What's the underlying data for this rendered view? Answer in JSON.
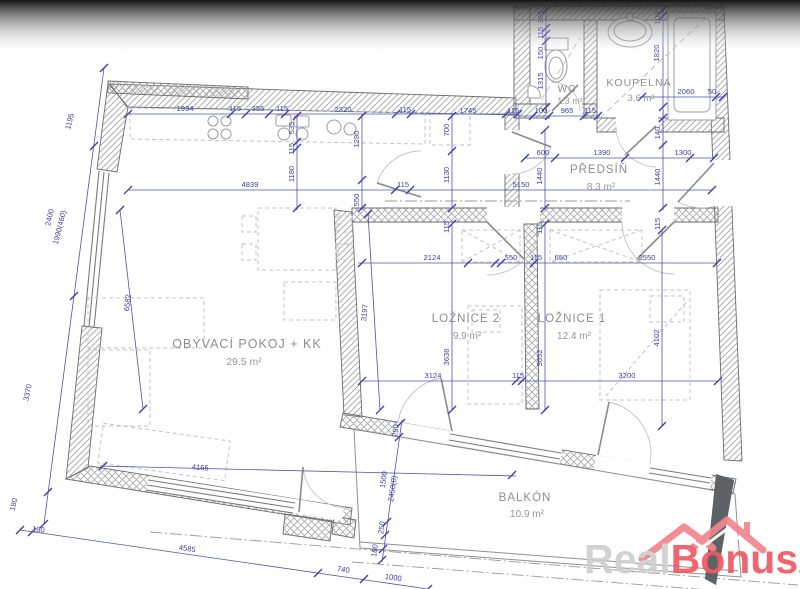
{
  "rooms": [
    {
      "name": "OBÝVACÍ POKOJ + KK",
      "area": "29.5 m²"
    },
    {
      "name": "LOŽNICE 2",
      "area": "9.9 m²"
    },
    {
      "name": "LOŽNICE 1",
      "area": "12.4 m²"
    },
    {
      "name": "PŘEDSÍŇ",
      "area": "8.3 m²"
    },
    {
      "name": "WC",
      "area": "1.3 m²"
    },
    {
      "name": "KOUPELNA",
      "area": "3.6 m²"
    },
    {
      "name": "BALKÓN",
      "area": "10.9 m²"
    }
  ],
  "dimensions": {
    "top_chain": [
      "1934",
      "115",
      "355",
      "115",
      "2320",
      "115",
      "1745",
      "115"
    ],
    "wc_bottom_chain": [
      "100",
      "965",
      "115"
    ],
    "wc_left_chain": [
      "365",
      "115",
      "150",
      "1315"
    ],
    "koupelna_dims": [
      "100",
      "1820",
      "2060",
      "50"
    ],
    "mid_chain": [
      "4839",
      "115",
      "5150"
    ],
    "kitchen_col": [
      "535",
      "115",
      "1180"
    ],
    "mid_verticals": [
      "1280",
      "550",
      "700",
      "1130"
    ],
    "predsin_chain": [
      "600",
      "1390",
      "1300"
    ],
    "predsin_verticals": [
      "1440",
      "140",
      "1440"
    ],
    "wall_thickness": [
      "115",
      "115",
      "115"
    ],
    "bedroom_top_chain": [
      "2124",
      "550",
      "115",
      "650",
      "2550"
    ],
    "bedroom_verticals": [
      "3197",
      "3636",
      "3652",
      "4102"
    ],
    "bedroom_bottom_chain": [
      "3124",
      "115",
      "3200"
    ],
    "living_diag": [
      "6582"
    ],
    "left_outer_chain": [
      "1195",
      "2400",
      "1990(460)",
      "3370",
      "180"
    ],
    "bottom_outer_chain": [
      "180",
      "4585",
      "740",
      "1000"
    ],
    "living_bottom": [
      "4165"
    ],
    "balcony_chain": [
      "250",
      "1500",
      "2450(0)",
      "250",
      "180"
    ]
  },
  "watermark": {
    "real": "Real",
    "bonus": "Bonus",
    "tld": ".cz"
  },
  "colors": {
    "dimension_blue": "#3f3fa0",
    "wall_gray": "#6b6b6b",
    "label_gray": "#8d8d8d",
    "logo_real": "#cfcfcf",
    "logo_bonus": "#ef5a64",
    "logo_roof": "#f2858d",
    "shadow_shape": "#5d6266"
  }
}
